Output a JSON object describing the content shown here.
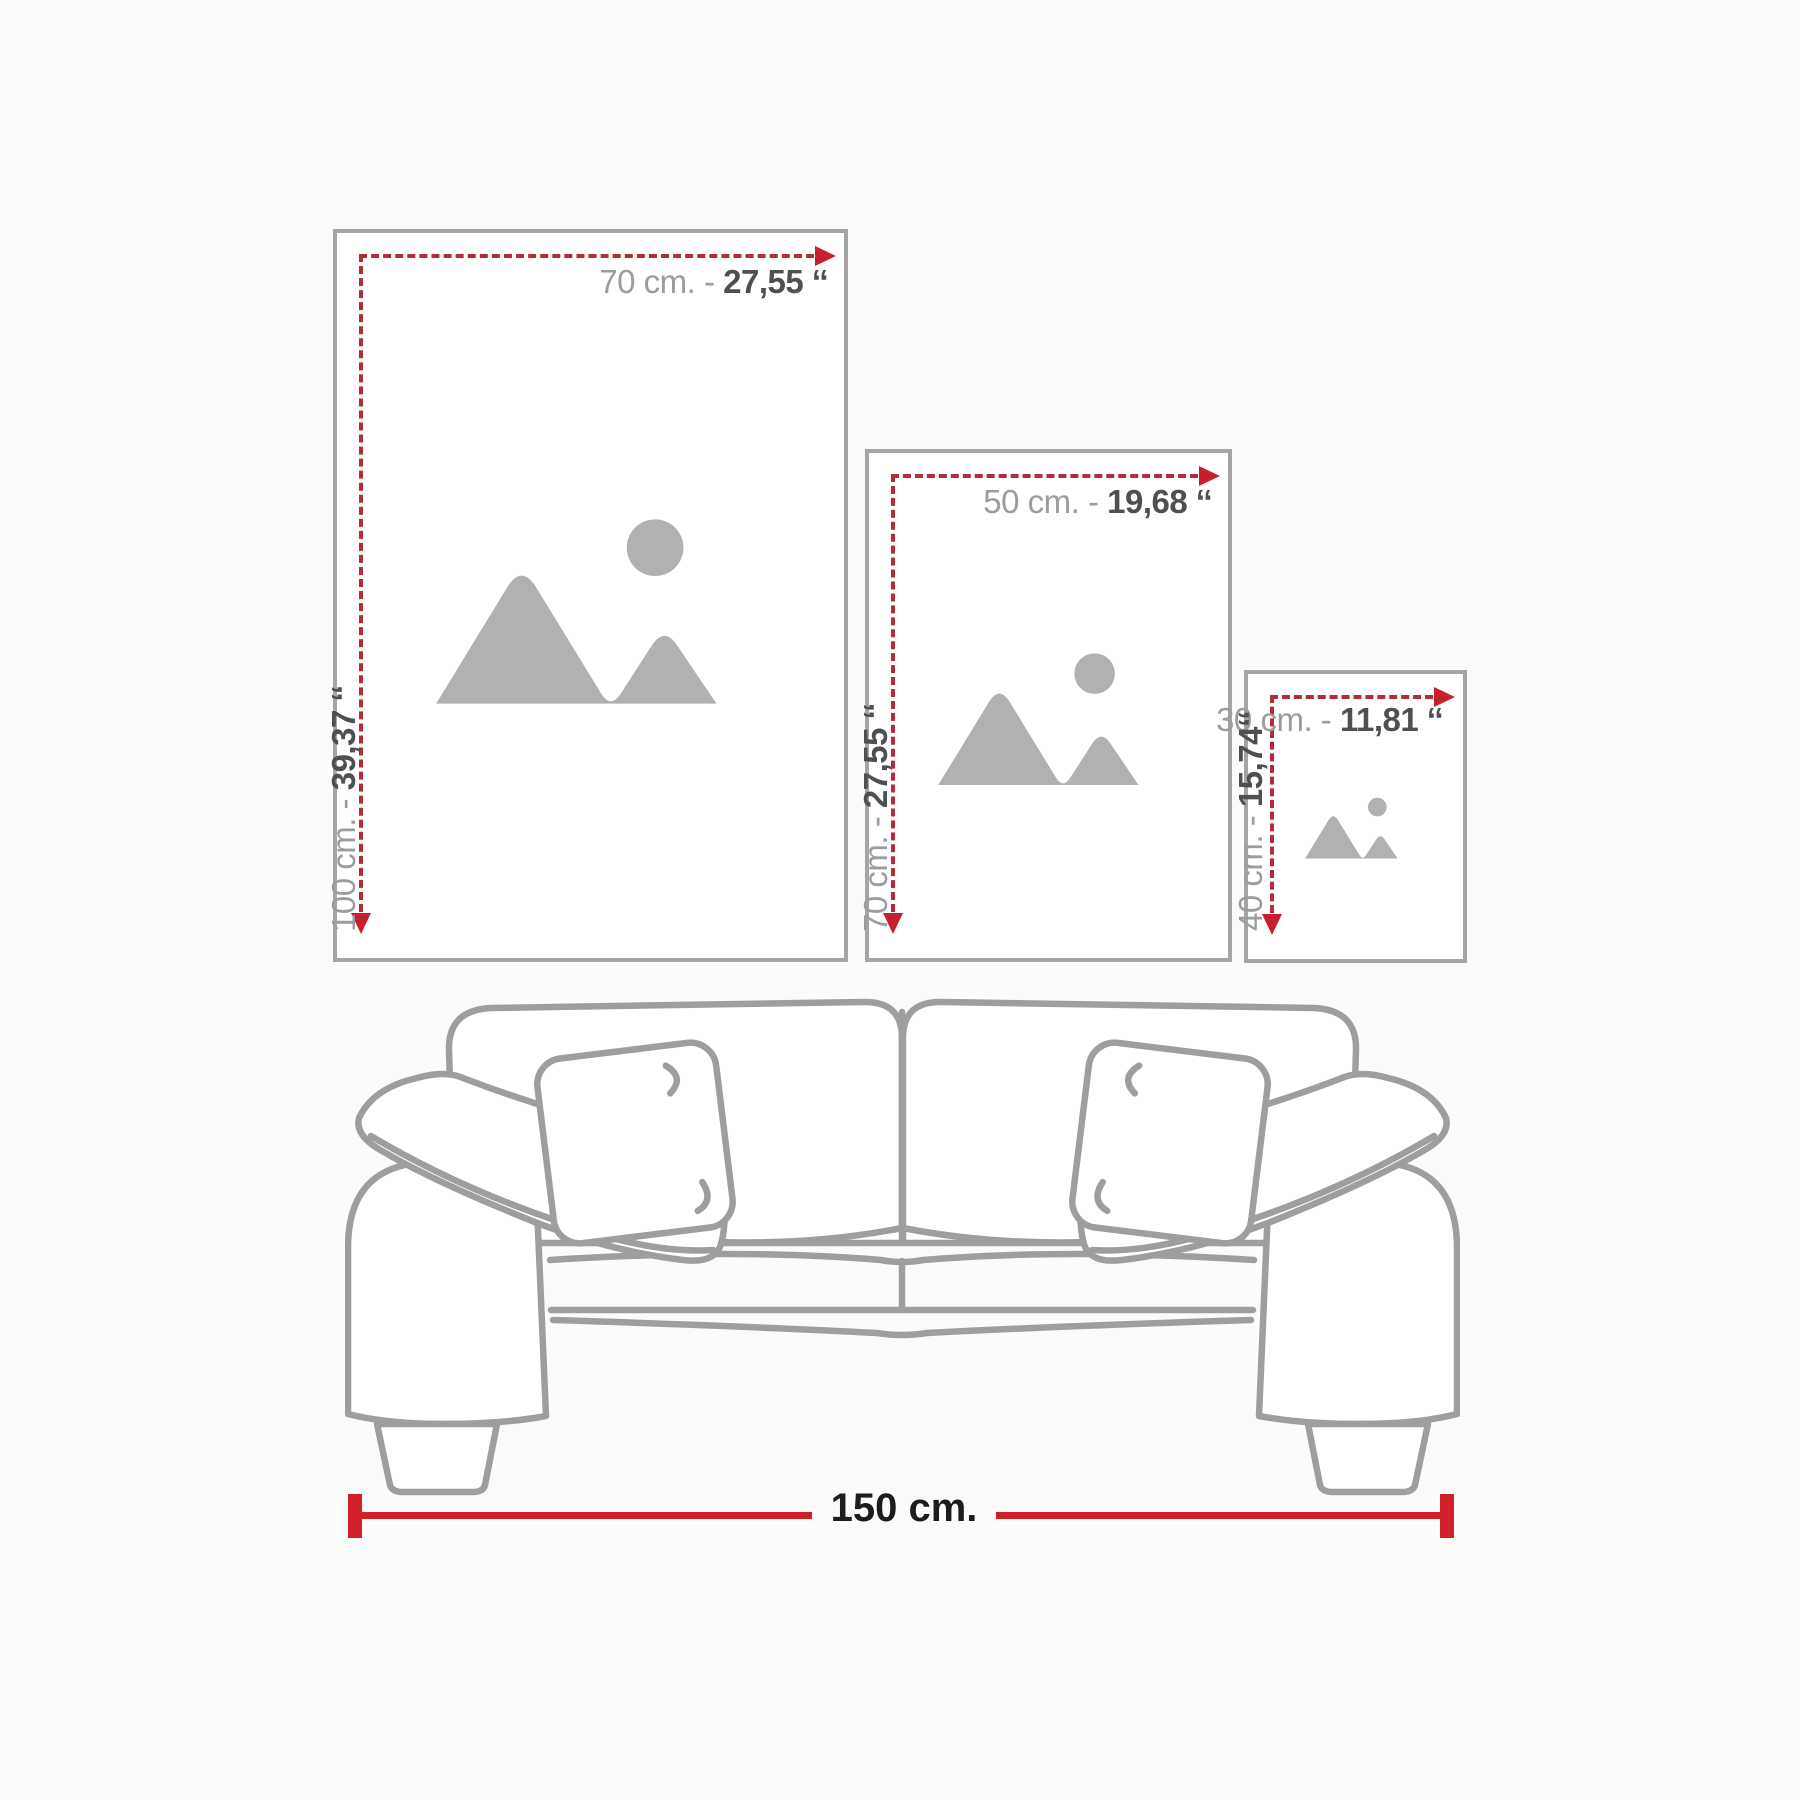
{
  "frames": [
    {
      "id": "large",
      "width_cm": "70 cm. -",
      "width_in": "27,55 ‘‘",
      "height_cm": "100 cm. -",
      "height_in": "39,37 ‘‘"
    },
    {
      "id": "medium",
      "width_cm": "50 cm. -",
      "width_in": "19,68 ‘‘",
      "height_cm": "70 cm. -",
      "height_in": "27,55 ‘‘"
    },
    {
      "id": "small",
      "width_cm": "30 cm. -",
      "width_in": "11,81 ‘‘",
      "height_cm": "40 cm. -",
      "height_in": "15,74‘‘"
    }
  ],
  "sofa": {
    "width_label": "150 cm."
  },
  "icons": {
    "placeholder": "image-placeholder-mountains-sun-icon",
    "width_arrow": "arrow-right-icon",
    "height_arrow": "arrow-down-icon"
  },
  "colors": {
    "accent_red": "#d2202a",
    "dash_red": "#b62b38",
    "arrow_red": "#c6202e",
    "frame_border": "#a5a5a5",
    "placeholder_gray": "#b1b1b1",
    "label_gray": "#9c9c9e",
    "label_dark": "#4e4f51",
    "sofa_line": "#9e9e9e",
    "measure_text": "#1c1c1c"
  }
}
